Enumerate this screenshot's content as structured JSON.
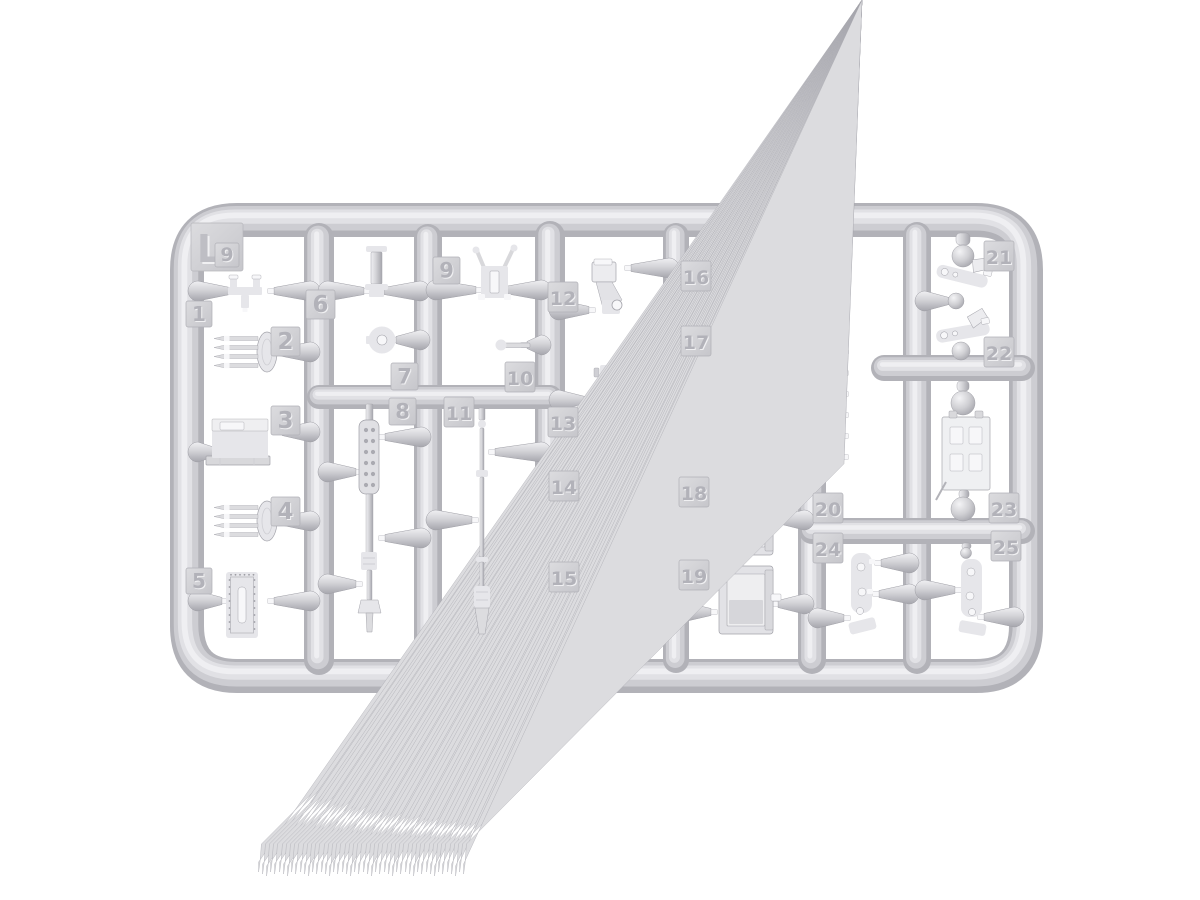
{
  "sprue": {
    "letter_tag": {
      "label": "L",
      "x": 191,
      "y": 223,
      "s": 52
    },
    "mold_mark_tag": {
      "label": "9",
      "x": 215,
      "y": 243,
      "s": 24
    },
    "part_tags": [
      {
        "label": "1",
        "x": 186,
        "y": 301,
        "s": 26
      },
      {
        "label": "2",
        "x": 271,
        "y": 327,
        "s": 29
      },
      {
        "label": "3",
        "x": 271,
        "y": 406,
        "s": 29
      },
      {
        "label": "4",
        "x": 271,
        "y": 497,
        "s": 29
      },
      {
        "label": "5",
        "x": 186,
        "y": 568,
        "s": 26
      },
      {
        "label": "6",
        "x": 306,
        "y": 290,
        "s": 29
      },
      {
        "label": "7",
        "x": 391,
        "y": 363,
        "s": 27
      },
      {
        "label": "8",
        "x": 389,
        "y": 398,
        "s": 27
      },
      {
        "label": "9",
        "x": 433,
        "y": 257,
        "s": 27
      },
      {
        "label": "10",
        "x": 505,
        "y": 362,
        "s": 30
      },
      {
        "label": "11",
        "x": 444,
        "y": 397,
        "s": 30
      },
      {
        "label": "12",
        "x": 548,
        "y": 282,
        "s": 30
      },
      {
        "label": "13",
        "x": 548,
        "y": 407,
        "s": 30
      },
      {
        "label": "14",
        "x": 549,
        "y": 471,
        "s": 30
      },
      {
        "label": "15",
        "x": 549,
        "y": 562,
        "s": 30
      },
      {
        "label": "16",
        "x": 681,
        "y": 261,
        "s": 30
      },
      {
        "label": "17",
        "x": 681,
        "y": 326,
        "s": 30
      },
      {
        "label": "18",
        "x": 679,
        "y": 477,
        "s": 30
      },
      {
        "label": "19",
        "x": 679,
        "y": 560,
        "s": 30
      },
      {
        "label": "20",
        "x": 813,
        "y": 493,
        "s": 30
      },
      {
        "label": "21",
        "x": 984,
        "y": 241,
        "s": 30
      },
      {
        "label": "22",
        "x": 984,
        "y": 337,
        "s": 30
      },
      {
        "label": "23",
        "x": 989,
        "y": 493,
        "s": 30
      },
      {
        "label": "24",
        "x": 813,
        "y": 533,
        "s": 30
      },
      {
        "label": "25",
        "x": 991,
        "y": 531,
        "s": 30
      }
    ],
    "colors": {
      "background": "#ffffff",
      "plastic_mid": "#cdcdd2",
      "plastic_dark": "#a6a6ad",
      "plastic_light": "#efeff2",
      "tag_face": "#d0d0d4",
      "number_emboss": "#b2b2b9"
    }
  }
}
